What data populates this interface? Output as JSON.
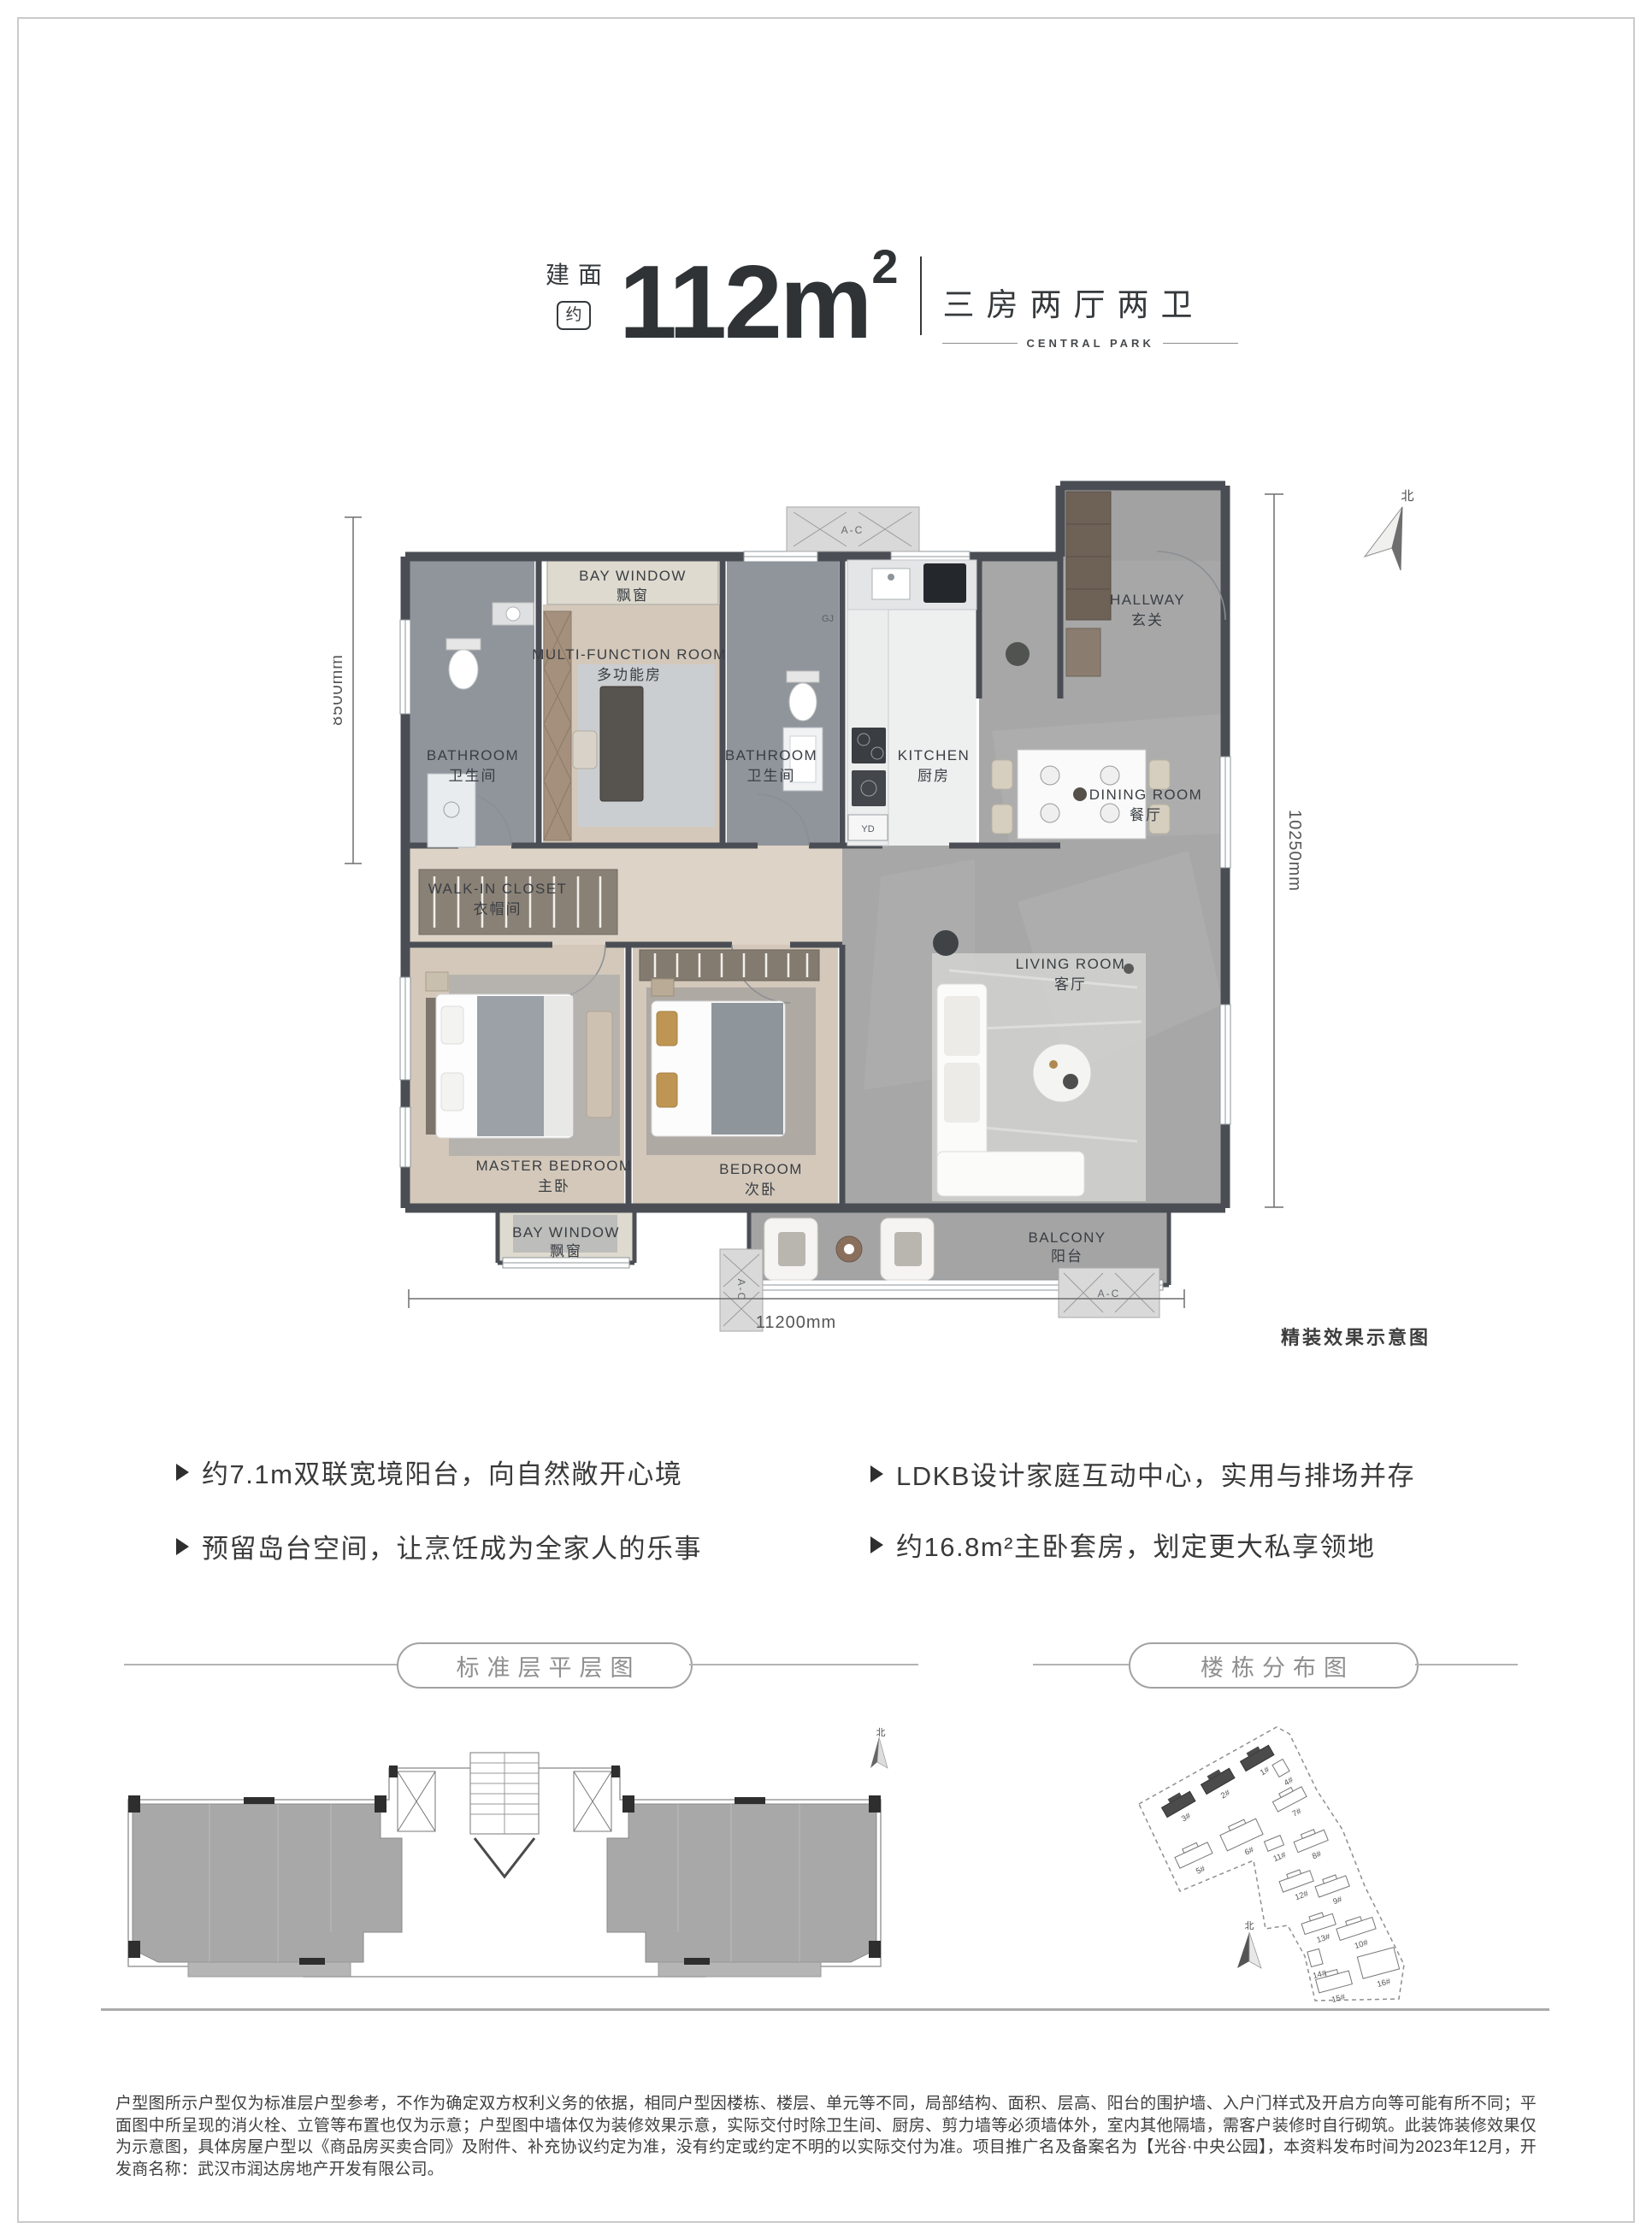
{
  "header": {
    "area_prefix": "建面",
    "area_approx": "约",
    "area_value": "112m",
    "area_sup": "2",
    "layout": "三房两厅两卫",
    "subtitle": "CENTRAL PARK"
  },
  "plan": {
    "rooms": [
      {
        "en": "BAY WINDOW",
        "zh": "飘窗"
      },
      {
        "en": "MULTI-FUNCTION ROOM",
        "zh": "多功能房"
      },
      {
        "en": "BATHROOM",
        "zh": "卫生间"
      },
      {
        "en": "BATHROOM",
        "zh": "卫生间"
      },
      {
        "en": "KITCHEN",
        "zh": "厨房"
      },
      {
        "en": "HALLWAY",
        "zh": "玄关"
      },
      {
        "en": "DINING ROOM",
        "zh": "餐厅"
      },
      {
        "en": "WALK-IN CLOSET",
        "zh": "衣帽间"
      },
      {
        "en": "LIVING ROOM",
        "zh": "客厅"
      },
      {
        "en": "MASTER BEDROOM",
        "zh": "主卧"
      },
      {
        "en": "BEDROOM",
        "zh": "次卧"
      },
      {
        "en": "BAY WINDOW",
        "zh": "飘窗"
      },
      {
        "en": "BALCONY",
        "zh": "阳台"
      }
    ],
    "dims": {
      "left": "8500mm",
      "right": "10250mm",
      "bottom": "11200mm"
    },
    "north_label": "北",
    "ac_label": "A-C",
    "yd_label": "YD",
    "gj_label": "GJ",
    "caption": "精装效果示意图"
  },
  "features": {
    "left": [
      {
        "text": "约7.1m双联宽境阳台，向自然敞开心境"
      },
      {
        "text": "预留岛台空间，让烹饪成为全家人的乐事"
      }
    ],
    "right": [
      {
        "text": "LDKB设计家庭互动中心，实用与排场并存"
      },
      {
        "text": "约16.8m²主卧套房，划定更大私享领地"
      }
    ]
  },
  "sections": {
    "floor_plate": "标准层平层图",
    "site_map": "楼栋分布图"
  },
  "site": {
    "buildings": [
      {
        "label": "3#",
        "highlighted": true
      },
      {
        "label": "2#",
        "highlighted": true
      },
      {
        "label": "1#",
        "highlighted": true
      },
      {
        "label": "4#",
        "highlighted": false
      },
      {
        "label": "7#",
        "highlighted": false
      },
      {
        "label": "5#",
        "highlighted": false
      },
      {
        "label": "6#",
        "highlighted": false
      },
      {
        "label": "11#",
        "highlighted": false
      },
      {
        "label": "8#",
        "highlighted": false
      },
      {
        "label": "12#",
        "highlighted": false
      },
      {
        "label": "9#",
        "highlighted": false
      },
      {
        "label": "13#",
        "highlighted": false
      },
      {
        "label": "10#",
        "highlighted": false
      },
      {
        "label": "14#",
        "highlighted": false
      },
      {
        "label": "15#",
        "highlighted": false
      },
      {
        "label": "16#",
        "highlighted": false
      }
    ]
  },
  "disclaimer": "户型图所示户型仅为标准层户型参考，不作为确定双方权利义务的依据，相同户型因楼栋、楼层、单元等不同，局部结构、面积、层高、阳台的围护墙、入户门样式及开启方向等可能有所不同；平面图中所呈现的消火栓、立管等布置也仅为示意；户型图中墙体仅为装修效果示意，实际交付时除卫生间、厨房、剪力墙等必须墙体外，室内其他隔墙，需客户装修时自行砌筑。此装饰装修效果仅为示意图，具体房屋户型以《商品房买卖合同》及附件、补充协议约定为准，没有约定或约定不明的以实际交付为准。项目推广名及备案名为【光谷·中央公园】，本资料发布时间为2023年12月，开发商名称：武汉市润达房地产开发有限公司。"
}
